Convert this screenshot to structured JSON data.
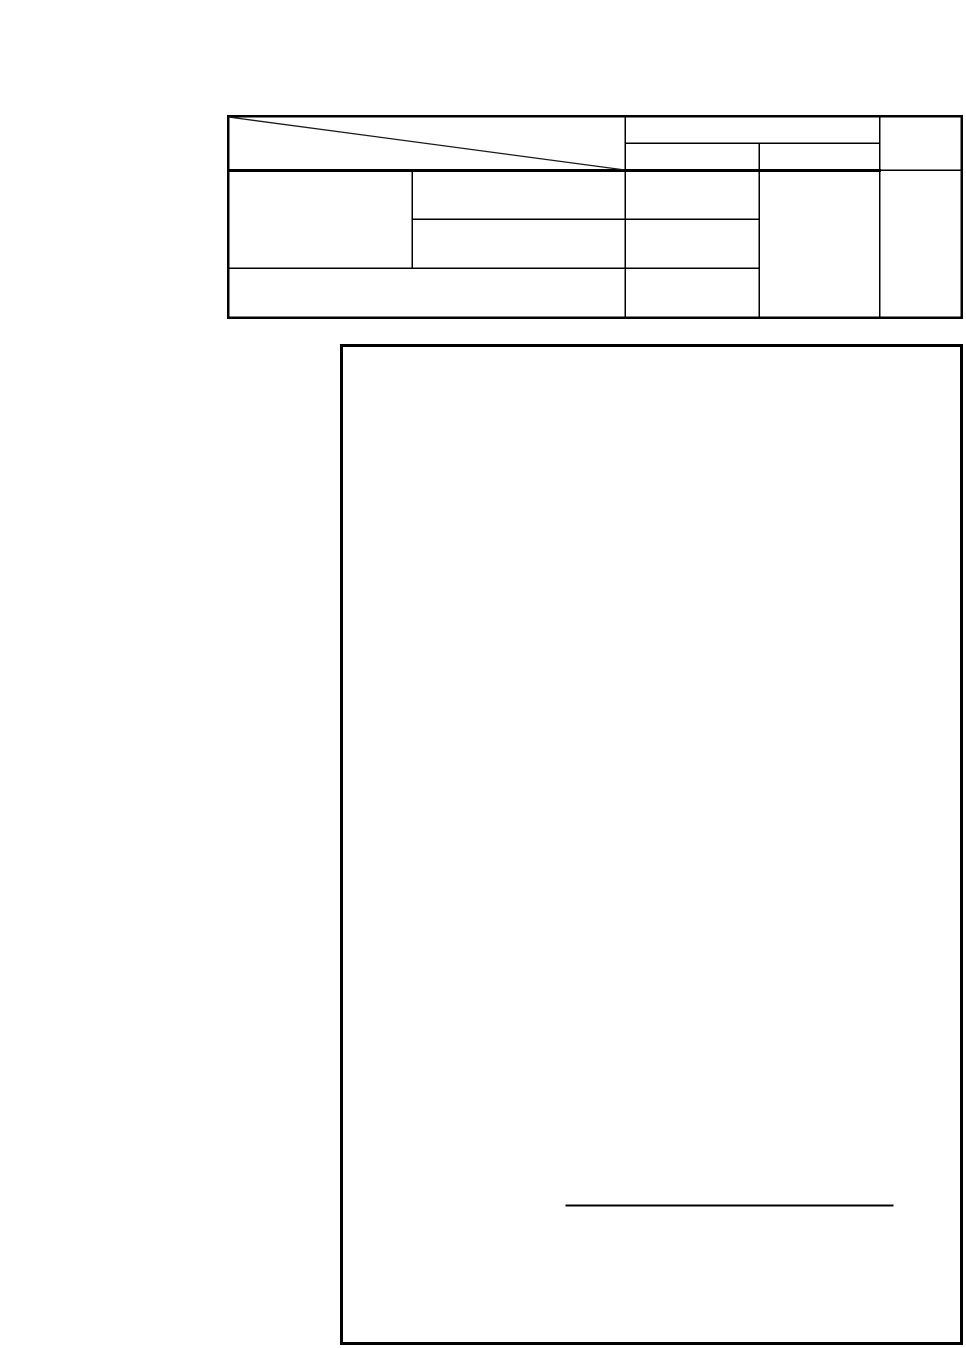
{
  "colors": {
    "page_background": "#ffffff",
    "ink": "#000000",
    "ink_soft": "#1a1a1a"
  },
  "table": {
    "cells_text": {
      "diagonal_header": "",
      "header_group": "",
      "header_sub_left": "",
      "header_sub_right": "",
      "header_right_column": "",
      "body_left_tall": "",
      "body_mid_row1": "",
      "body_mid_row2": "",
      "body_col3_row1": "",
      "body_col3_row2": "",
      "body_col3_row3": "",
      "body_bottom_wide": "",
      "body_col4_tall": "",
      "body_col5_tall": ""
    }
  },
  "figure_box": {
    "text": ""
  }
}
